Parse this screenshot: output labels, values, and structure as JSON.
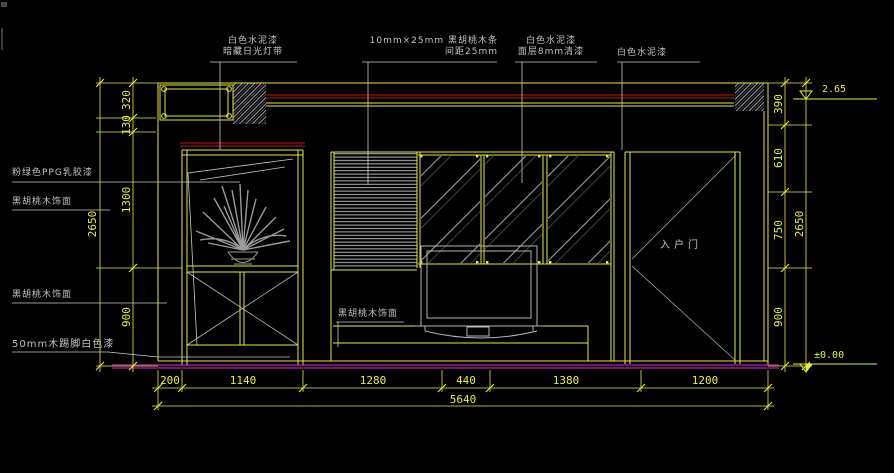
{
  "drawing": {
    "annotations": {
      "top": [
        {
          "line1": "白色水泥漆",
          "line2": "暗藏日光灯带"
        },
        {
          "line1": "10mm×25mm 黑胡桃木条",
          "line2": "间距25mm"
        },
        {
          "line1": "白色水泥漆",
          "line2": "面层8mm清漆"
        },
        {
          "line1": "白色水泥漆",
          "line2": ""
        }
      ],
      "left": [
        {
          "text": "粉绿色PPG乳胶漆"
        },
        {
          "text": "黑胡桃木饰面"
        },
        {
          "text": "黑胡桃木饰面"
        },
        {
          "text": "50mm木踢脚白色漆"
        }
      ],
      "tv_wall": {
        "text": "黑胡桃木饰面"
      },
      "door": {
        "text": "入户门"
      }
    },
    "levels": {
      "top": "2.65",
      "bottom": "±0.00"
    },
    "dimensions": {
      "left": [
        "320",
        "130",
        "1300",
        "900"
      ],
      "left_total": "2650",
      "right": [
        "390",
        "610",
        "750",
        "900"
      ],
      "right_total": "2650",
      "bottom": [
        "200",
        "1140",
        "1280",
        "440",
        "1380",
        "1200"
      ],
      "bottom_total": "5640"
    },
    "colors": {
      "background": "#000000",
      "line_yellow": "#e9e93f",
      "line_white": "#c8c8c8",
      "line_red": "#c81414",
      "floor_magenta": "#b619b6",
      "dim_text": "#ecec45"
    }
  }
}
